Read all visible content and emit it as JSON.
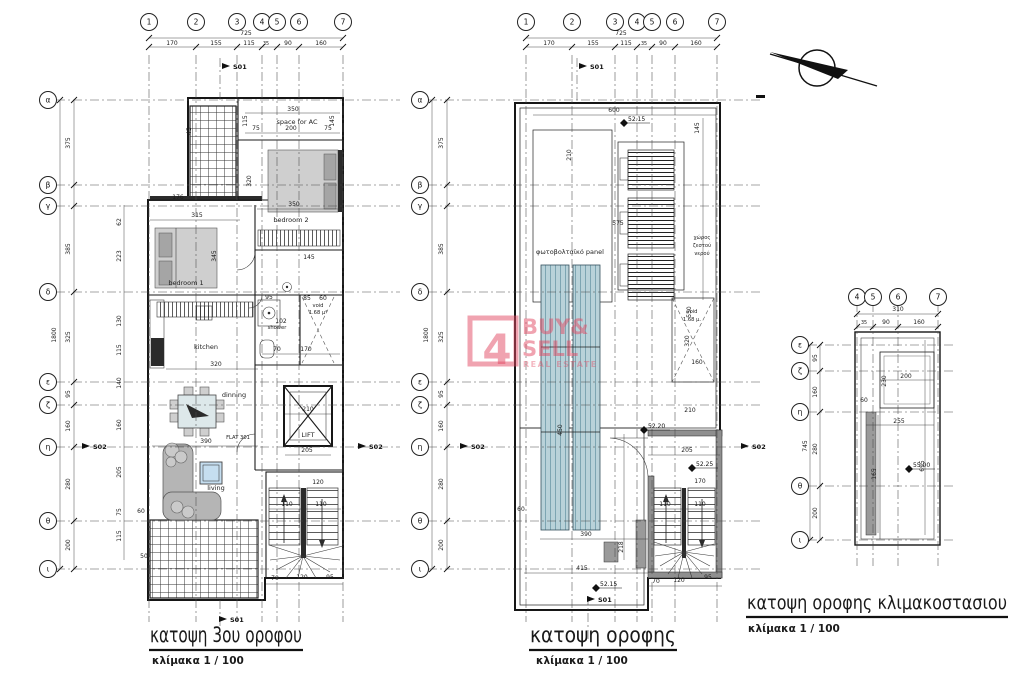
{
  "titles": {
    "plan1": "κατοψη 3ου οροφου",
    "plan2": "κατοψη οροφης",
    "plan3": "κατοψη οροφης κλιμακοστασιου",
    "scale": "κλίμακα 1 / 100"
  },
  "watermark": {
    "logo_char": "4",
    "line1": "BUY&",
    "line2": "SELL",
    "line3": "REAL ESTATE"
  },
  "rooms": {
    "bedroom1": "bedroom 1",
    "bedroom2": "bedroom 2",
    "kitchen": "kitchen",
    "dinning": "dinning",
    "living": "living",
    "shower": "shower",
    "lift": "LIFT",
    "void1": "void",
    "void1_area": "1.68 μ²",
    "flat": "FLAT 301",
    "space_for_ac": "space for AC",
    "pv_panel": "φωτοβολταϊκό panel",
    "water_line1": "χώρος",
    "water_line2": "ζεστού",
    "water_line3": "νερού",
    "void2": "void",
    "void2_area": "1.68 μ."
  },
  "colors": {
    "watermark_pink": "#e24862",
    "wall_gray": "#8f8f8f",
    "pv_blue": "#b9d2d9"
  },
  "plans": [
    {
      "name": "katopsi-3ou-orofou",
      "cols": [
        {
          "t": "1",
          "x": 149
        },
        {
          "t": "2",
          "x": 196
        },
        {
          "t": "3",
          "x": 237
        },
        {
          "t": "4",
          "x": 262
        },
        {
          "t": "5",
          "x": 277
        },
        {
          "t": "6",
          "x": 299
        },
        {
          "t": "7",
          "x": 343
        }
      ],
      "rows": [
        {
          "t": "α",
          "y": 100
        },
        {
          "t": "β",
          "y": 185
        },
        {
          "t": "γ",
          "y": 206
        },
        {
          "t": "δ",
          "y": 292
        },
        {
          "t": "ε",
          "y": 382
        },
        {
          "t": "ζ",
          "y": 405
        },
        {
          "t": "η",
          "y": 447
        },
        {
          "t": "θ",
          "y": 521
        },
        {
          "t": "ι",
          "y": 569
        }
      ],
      "labels": [
        [
          "725",
          246,
          35
        ],
        [
          "170",
          172,
          45
        ],
        [
          "155",
          216,
          45
        ],
        [
          "115",
          249,
          45
        ],
        [
          "35",
          266,
          45,
          "t"
        ],
        [
          "90",
          288,
          45
        ],
        [
          "160",
          321,
          45
        ],
        [
          "1800",
          56,
          335,
          "r"
        ],
        [
          "375",
          70,
          143,
          "r"
        ],
        [
          "385",
          70,
          249,
          "r"
        ],
        [
          "325",
          70,
          337,
          "r"
        ],
        [
          "95",
          70,
          394,
          "r"
        ],
        [
          "160",
          70,
          426,
          "r"
        ],
        [
          "280",
          70,
          484,
          "r"
        ],
        [
          "200",
          70,
          545,
          "r"
        ],
        [
          "62",
          121,
          222,
          "r"
        ],
        [
          "223",
          121,
          256,
          "r"
        ],
        [
          "130",
          121,
          321,
          "r"
        ],
        [
          "115",
          121,
          350,
          "r"
        ],
        [
          "140",
          121,
          383,
          "r"
        ],
        [
          "160",
          121,
          425,
          "r"
        ],
        [
          "205",
          121,
          472,
          "r"
        ],
        [
          "75",
          121,
          512,
          "r"
        ],
        [
          "115",
          121,
          536,
          "r"
        ],
        [
          "45",
          191,
          131,
          "r"
        ],
        [
          "350",
          293,
          111
        ],
        [
          "75",
          256,
          130
        ],
        [
          "200",
          291,
          130
        ],
        [
          "75",
          328,
          130
        ],
        [
          "115",
          247,
          121,
          "r"
        ],
        [
          "145",
          334,
          121,
          "r"
        ],
        [
          "320",
          251,
          181,
          "r"
        ],
        [
          "176",
          178,
          199
        ],
        [
          "315",
          197,
          217
        ],
        [
          "350",
          294,
          206
        ],
        [
          "345",
          216,
          256,
          "r"
        ],
        [
          "145",
          309,
          259
        ],
        [
          "95",
          269,
          299
        ],
        [
          "85",
          307,
          300
        ],
        [
          "60",
          323,
          300
        ],
        [
          "102",
          281,
          323
        ],
        [
          "70",
          277,
          351
        ],
        [
          "170",
          306,
          351
        ],
        [
          "320",
          216,
          366
        ],
        [
          "390",
          206,
          443
        ],
        [
          "210",
          308,
          411
        ],
        [
          "205",
          307,
          452
        ],
        [
          "120",
          318,
          484
        ],
        [
          "110",
          287,
          506
        ],
        [
          "110",
          321,
          506
        ],
        [
          "60",
          141,
          513
        ],
        [
          "50",
          144,
          558
        ],
        [
          "70",
          275,
          580
        ],
        [
          "120",
          302,
          579
        ],
        [
          "95",
          330,
          579
        ],
        [
          "S01",
          233,
          69,
          "m"
        ],
        [
          "S02",
          93,
          449,
          "m"
        ],
        [
          "S02",
          369,
          449,
          "m"
        ],
        [
          "S01",
          230,
          622,
          "m"
        ]
      ]
    },
    {
      "name": "katopsi-orofis",
      "cols": [
        {
          "t": "1",
          "x": 526
        },
        {
          "t": "2",
          "x": 572
        },
        {
          "t": "3",
          "x": 615
        },
        {
          "t": "4",
          "x": 637
        },
        {
          "t": "5",
          "x": 652
        },
        {
          "t": "6",
          "x": 675
        },
        {
          "t": "7",
          "x": 717
        }
      ],
      "rows": [
        {
          "t": "α",
          "y": 100
        },
        {
          "t": "β",
          "y": 185
        },
        {
          "t": "γ",
          "y": 206
        },
        {
          "t": "δ",
          "y": 292
        },
        {
          "t": "ε",
          "y": 382
        },
        {
          "t": "ζ",
          "y": 405
        },
        {
          "t": "η",
          "y": 447
        },
        {
          "t": "θ",
          "y": 521
        },
        {
          "t": "ι",
          "y": 569
        }
      ],
      "labels": [
        [
          "725",
          621,
          35
        ],
        [
          "170",
          549,
          45
        ],
        [
          "155",
          593,
          45
        ],
        [
          "115",
          626,
          45
        ],
        [
          "35",
          644,
          45,
          "t"
        ],
        [
          "90",
          663,
          45
        ],
        [
          "160",
          696,
          45
        ],
        [
          "1800",
          428,
          335,
          "r"
        ],
        [
          "375",
          443,
          143,
          "r"
        ],
        [
          "385",
          443,
          249,
          "r"
        ],
        [
          "325",
          443,
          337,
          "r"
        ],
        [
          "95",
          443,
          394,
          "r"
        ],
        [
          "160",
          443,
          426,
          "r"
        ],
        [
          "280",
          443,
          484,
          "r"
        ],
        [
          "200",
          443,
          545,
          "r"
        ],
        [
          "600",
          614,
          112
        ],
        [
          "52.15",
          628,
          121,
          "lvl"
        ],
        [
          "145",
          699,
          128,
          "r"
        ],
        [
          "210",
          571,
          155,
          "r"
        ],
        [
          "575",
          618,
          225
        ],
        [
          "550",
          691,
          312,
          "r"
        ],
        [
          "450",
          562,
          430,
          "r"
        ],
        [
          "320",
          689,
          341,
          "r"
        ],
        [
          "160",
          697,
          364
        ],
        [
          "210",
          690,
          412
        ],
        [
          "52.20",
          648,
          428,
          "lvl"
        ],
        [
          "205",
          687,
          452
        ],
        [
          "52.25",
          696,
          466,
          "lvl"
        ],
        [
          "170",
          700,
          483
        ],
        [
          "110",
          665,
          506
        ],
        [
          "110",
          700,
          506
        ],
        [
          "390",
          586,
          536
        ],
        [
          "60",
          521,
          511
        ],
        [
          "415",
          582,
          570
        ],
        [
          "218",
          623,
          547,
          "r"
        ],
        [
          "52.15",
          600,
          586,
          "lvl"
        ],
        [
          "70",
          656,
          583
        ],
        [
          "120",
          679,
          582
        ],
        [
          "95",
          708,
          579
        ],
        [
          "S01",
          590,
          69,
          "m"
        ],
        [
          "S01",
          598,
          602,
          "m"
        ],
        [
          "S02",
          471,
          449,
          "m"
        ],
        [
          "S02",
          752,
          449,
          "m"
        ]
      ]
    },
    {
      "name": "katopsi-orofis-klimakostasiou",
      "cols": [
        {
          "t": "4",
          "x": 857
        },
        {
          "t": "5",
          "x": 873
        },
        {
          "t": "6",
          "x": 898
        },
        {
          "t": "7",
          "x": 938
        }
      ],
      "rows": [
        {
          "t": "ε",
          "y": 345
        },
        {
          "t": "ζ",
          "y": 371
        },
        {
          "t": "η",
          "y": 412
        },
        {
          "t": "θ",
          "y": 486
        },
        {
          "t": "ι",
          "y": 540
        }
      ],
      "labels": [
        [
          "310",
          898,
          311
        ],
        [
          "35",
          864,
          324,
          "t"
        ],
        [
          "90",
          886,
          324
        ],
        [
          "160",
          919,
          324
        ],
        [
          "745",
          807,
          446,
          "r"
        ],
        [
          "95",
          817,
          358,
          "r"
        ],
        [
          "160",
          817,
          392,
          "r"
        ],
        [
          "280",
          817,
          449,
          "r"
        ],
        [
          "200",
          817,
          513,
          "r"
        ],
        [
          "200",
          906,
          378
        ],
        [
          "230",
          886,
          381,
          "r"
        ],
        [
          "60",
          864,
          402
        ],
        [
          "255",
          899,
          423
        ],
        [
          "695",
          924,
          466,
          "r"
        ],
        [
          "165",
          876,
          474,
          "r"
        ],
        [
          "55.00",
          913,
          467,
          "lvl"
        ]
      ]
    }
  ]
}
